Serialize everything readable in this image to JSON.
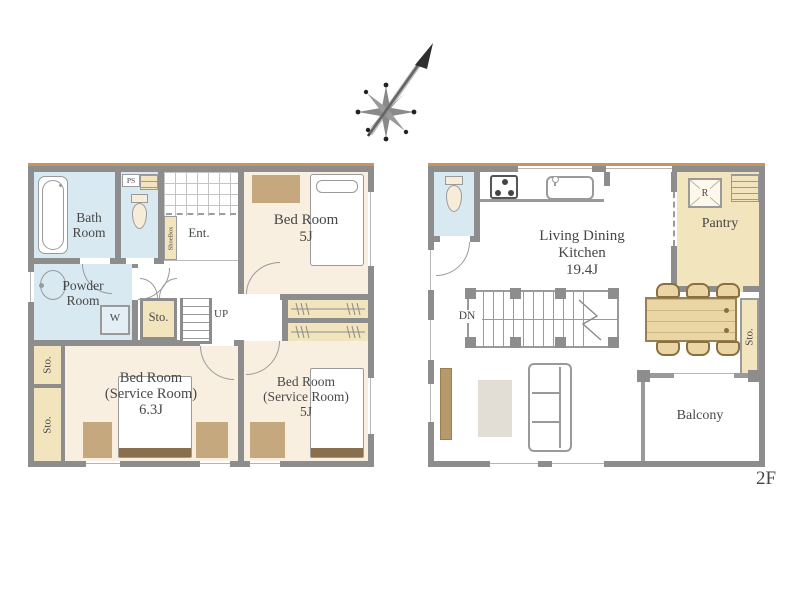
{
  "compass": {
    "icon": "north-arrow-icon"
  },
  "floor1": {
    "bath_room": {
      "lines": [
        "Bath",
        "Room"
      ]
    },
    "ps_label": "PS",
    "shoebox_label": "ShoeBox",
    "entrance_label": "Ent.",
    "bedroom_a": {
      "lines": [
        "Bed Room",
        "5J"
      ]
    },
    "powder_room": {
      "lines": [
        "Powder",
        "Room"
      ]
    },
    "washer_label": "W",
    "storage_hall_label": "Sto.",
    "stairs_up_label": "UP",
    "storage_left_upper_label": "Sto.",
    "storage_left_lower_label": "Sto.",
    "bedroom_b": {
      "lines": [
        "Bed Room",
        "(Service Room)",
        "6.3J"
      ]
    },
    "bedroom_c": {
      "lines": [
        "Bed Room",
        "(Service Room)",
        "5J"
      ]
    }
  },
  "floor2": {
    "refrigerator_label": "R",
    "pantry_label": "Pantry",
    "ldk": {
      "lines": [
        "Living Dining",
        "Kitchen",
        "19.4J"
      ]
    },
    "stairs_down_label": "DN",
    "storage_right_label": "Sto.",
    "balcony_label": "Balcony",
    "floor_tag": "2F"
  },
  "colors": {
    "wall": "#8d8d8d",
    "top_accent": "#c9935c",
    "floor_cream": "#f8efe1",
    "floor_blue": "#d9e9f2",
    "floor_tan": "#f2e5bd",
    "wood": "#ead5a5",
    "furniture_brown": "#c5a87e",
    "bed_band": "#8a6f4e",
    "text": "#474747"
  }
}
